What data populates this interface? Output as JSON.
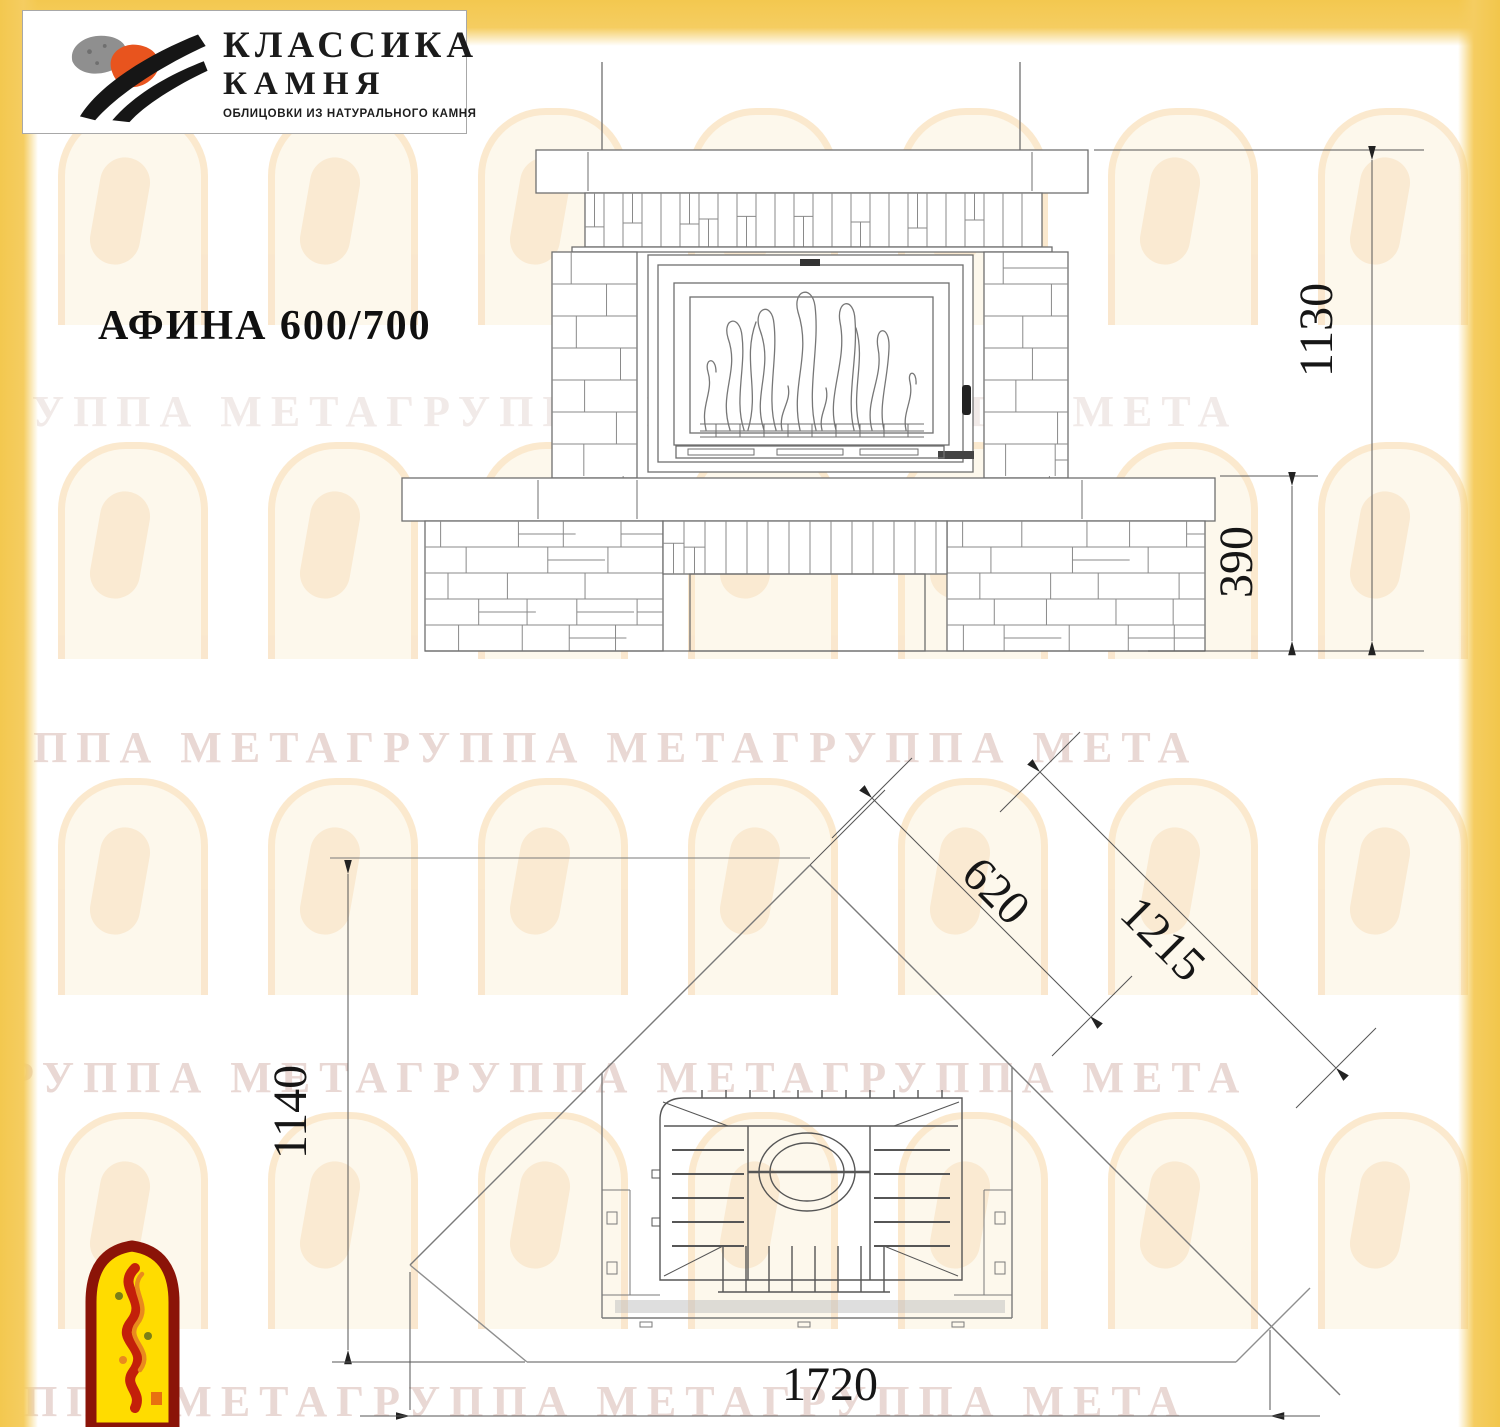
{
  "brand": {
    "name_line1": "КЛАССИКА",
    "name_line2": "КАМНЯ",
    "tagline": "ОБЛИЦОВКИ ИЗ НАТУРАЛЬНОГО КАМНЯ"
  },
  "model": {
    "title": "АФИНА 600/700"
  },
  "front_view": {
    "dim_total_height": "1130",
    "dim_base_height": "390"
  },
  "plan_view": {
    "dim_depth_from_corner": "1140",
    "dim_firebox_diagonal": "620",
    "dim_back_diagonal": "1215",
    "dim_front_width": "1720"
  },
  "watermark": {
    "text": "ГРУППА МЕТАГРУППА МЕТАГРУППА МЕТА"
  },
  "colors": {
    "frame_yellow": "#F4CA55",
    "logo_orange": "#E8541E",
    "logo_gray": "#8F8F8F",
    "logo_black": "#1A1A1A",
    "meta_red": "#8B1408",
    "meta_yellow": "#FFDC00",
    "line_gray": "#6E6E6E"
  }
}
